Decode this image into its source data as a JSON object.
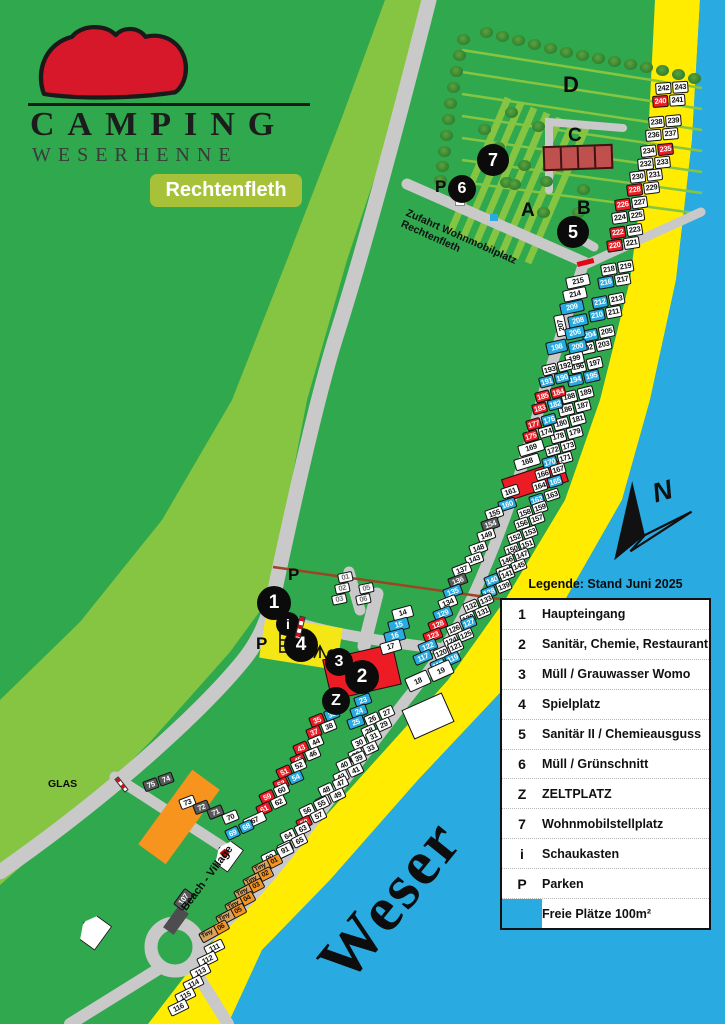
{
  "logo": {
    "line1": "CAMPING",
    "line2": "WESERHENNE",
    "badge": "Rechtenfleth"
  },
  "legend": {
    "title": "Legende: Stand Juni 2025",
    "rows": [
      {
        "sym": "1",
        "label": "Haupteingang",
        "swatch": false
      },
      {
        "sym": "2",
        "label": "Sanitär, Chemie, Restaurant",
        "swatch": false
      },
      {
        "sym": "3",
        "label": "Müll / Grauwasser Womo",
        "swatch": false
      },
      {
        "sym": "4",
        "label": "Spielplatz",
        "swatch": false
      },
      {
        "sym": "5",
        "label": "Sanitär II / Chemieausguss",
        "swatch": false
      },
      {
        "sym": "6",
        "label": "Müll / Grünschnitt",
        "swatch": false
      },
      {
        "sym": "Z",
        "label": "ZELTPLATZ",
        "swatch": false
      },
      {
        "sym": "7",
        "label": "Wohnmobilstellplatz",
        "swatch": false
      },
      {
        "sym": "i",
        "label": "Schaukasten",
        "swatch": false
      },
      {
        "sym": "P",
        "label": "Parken",
        "swatch": false
      },
      {
        "sym": "",
        "label": "Freie Plätze 100m²",
        "swatch": true
      }
    ]
  },
  "map_labels": {
    "weser": "Weser",
    "beach": "Beach - Village",
    "zufahrt": "Zufahrt Wohnmobilplatz Rechtenfleth",
    "glas": "GLAS",
    "north": "N",
    "sections": [
      {
        "t": "D",
        "x": 563,
        "y": 72,
        "s": 22
      },
      {
        "t": "C",
        "x": 568,
        "y": 125,
        "s": 19
      },
      {
        "t": "A",
        "x": 521,
        "y": 200,
        "s": 19
      },
      {
        "t": "B",
        "x": 577,
        "y": 198,
        "s": 19
      }
    ]
  },
  "markers": [
    {
      "t": "1",
      "x": 274,
      "y": 603,
      "r": 17
    },
    {
      "t": "i",
      "x": 288,
      "y": 624,
      "r": 12
    },
    {
      "t": "4",
      "x": 301,
      "y": 645,
      "r": 17
    },
    {
      "t": "3",
      "x": 339,
      "y": 662,
      "r": 14
    },
    {
      "t": "2",
      "x": 362,
      "y": 677,
      "r": 17
    },
    {
      "t": "Z",
      "x": 336,
      "y": 701,
      "r": 14
    },
    {
      "t": "5",
      "x": 573,
      "y": 232,
      "r": 16
    },
    {
      "t": "6",
      "x": 462,
      "y": 189,
      "r": 14
    },
    {
      "t": "7",
      "x": 493,
      "y": 160,
      "r": 16
    }
  ],
  "p_letters": [
    [
      288,
      565
    ],
    [
      256,
      634
    ],
    [
      435,
      177
    ]
  ],
  "colors": {
    "land": "#2fa84e",
    "dike": "#86c541",
    "beach": "#ffec00",
    "water": "#29abe2",
    "road": "#c9c9c9",
    "free_pitch": "#29abe2",
    "red_pitch": "#ed1c24",
    "gray_pitch": "#58595b",
    "building_c": "#c0504d",
    "orange": "#f7941d",
    "badge": "#a7c239",
    "hen_red": "#d7182a"
  },
  "pitch_rows": [
    [
      655,
      83,
      -4,
      "242:w,243:w",
      16,
      12
    ],
    [
      652,
      96,
      -4,
      "240:r,241:w",
      16,
      12
    ],
    [
      648,
      117,
      -5,
      "238:w,239:w",
      16,
      12
    ],
    [
      645,
      130,
      -5,
      "236:w,237:w",
      16,
      12
    ],
    [
      640,
      146,
      -6,
      "234:w,235:r",
      16,
      12
    ],
    [
      637,
      159,
      -6,
      "232:w,233:w",
      16,
      12
    ],
    [
      629,
      172,
      -7,
      "230:w,231:w",
      16,
      12
    ],
    [
      626,
      185,
      -7,
      "228:r,229:w",
      16,
      12
    ],
    [
      614,
      200,
      -8,
      "226:r,227:w",
      16,
      12
    ],
    [
      611,
      213,
      -8,
      "224:w,225:w",
      16,
      12
    ],
    [
      609,
      228,
      -9,
      "222:r,223:w",
      16,
      12
    ],
    [
      606,
      241,
      -9,
      "220:r,221:w",
      16,
      12
    ],
    [
      600,
      265,
      -10,
      "218:w,219:w",
      16,
      12
    ],
    [
      597,
      278,
      -10,
      "216:b,217:w",
      16,
      12
    ],
    [
      591,
      298,
      -11,
      "212:b,213:w",
      16,
      12
    ],
    [
      588,
      311,
      -11,
      "210:b,211:w",
      16,
      12
    ],
    [
      581,
      331,
      -12,
      "204:b,205:w",
      16,
      12
    ],
    [
      578,
      344,
      -12,
      "202:w,203:w",
      16,
      12
    ],
    [
      569,
      363,
      -13,
      "196:w,197:w",
      16,
      12
    ],
    [
      566,
      376,
      -13,
      "194:b,195:b",
      16,
      12
    ],
    [
      560,
      393,
      -14,
      "188:w,189:w",
      16,
      12
    ],
    [
      557,
      406,
      -14,
      "186:w,187:w",
      16,
      12
    ],
    [
      552,
      420,
      -15,
      "180:w,181:w",
      16,
      12
    ],
    [
      549,
      433,
      -15,
      "178:w,179:w",
      16,
      12
    ],
    [
      544,
      447,
      -16,
      "172:w,173:w",
      15,
      11
    ],
    [
      541,
      459,
      -16,
      "170:b,171:w",
      15,
      11
    ],
    [
      534,
      471,
      -17,
      "166:w,167:w",
      15,
      11
    ],
    [
      531,
      483,
      -17,
      "164:w,165:b",
      15,
      11
    ],
    [
      528,
      497,
      -18,
      "162:b,163:w",
      15,
      11
    ],
    [
      516,
      510,
      -19,
      "158:w,159:w",
      15,
      11
    ],
    [
      513,
      521,
      -19,
      "156:w,157:w",
      15,
      11
    ],
    [
      506,
      535,
      -20,
      "152:w,153:w",
      15,
      11
    ],
    [
      503,
      547,
      -20,
      "150:w,151:w",
      15,
      11
    ],
    [
      498,
      558,
      -21,
      "146:w,147:w",
      15,
      11
    ],
    [
      495,
      569,
      -21,
      "144:w,145:w",
      15,
      11
    ],
    [
      483,
      578,
      -22,
      "140:b,141:w",
      15,
      11
    ],
    [
      480,
      590,
      -22,
      "138:b,139:w",
      15,
      11
    ],
    [
      462,
      604,
      -23,
      "132:w,133:w",
      15,
      11
    ],
    [
      459,
      616,
      -23,
      "130:w,131:w",
      15,
      11
    ],
    [
      445,
      627,
      -23,
      "126:w,127:b",
      15,
      11
    ],
    [
      442,
      639,
      -23,
      "124:w,125:w",
      15,
      11
    ],
    [
      432,
      651,
      -24,
      "120:w,121:w",
      15,
      11
    ],
    [
      429,
      663,
      -24,
      "118:b,119:b",
      15,
      11
    ],
    [
      404,
      679,
      -24,
      "18:w,19:w",
      24,
      15
    ],
    [
      363,
      717,
      -24,
      "26:w,27:w",
      15,
      11
    ],
    [
      360,
      729,
      -24,
      "28:w,29:w",
      15,
      11
    ],
    [
      350,
      741,
      -25,
      "30:w,31:w",
      15,
      11
    ],
    [
      347,
      753,
      -25,
      "32:w,33:w",
      15,
      11
    ],
    [
      335,
      763,
      -25,
      "40:w,39:w",
      15,
      11
    ],
    [
      332,
      775,
      -25,
      "42:w,41:w",
      15,
      11
    ],
    [
      317,
      788,
      -25,
      "48:w,47:w",
      15,
      11
    ],
    [
      314,
      800,
      -25,
      "50:w,49:w",
      15,
      11
    ],
    [
      298,
      809,
      -26,
      "56:w,55:w",
      15,
      11
    ],
    [
      295,
      821,
      -26,
      "58:r,57:w",
      15,
      11
    ],
    [
      279,
      834,
      -26,
      "64:w,63:w",
      15,
      11
    ],
    [
      276,
      846,
      -26,
      "66:w,65:w",
      15,
      11
    ],
    [
      260,
      856,
      -26,
      "90:w,91:w",
      16,
      12
    ],
    [
      251,
      867,
      -27,
      "Tiny 01:t",
      31,
      11
    ],
    [
      242,
      880,
      -27,
      "Tiny 02:t",
      31,
      11
    ],
    [
      233,
      892,
      -28,
      "Tiny 03:t",
      31,
      11
    ],
    [
      224,
      905,
      -28,
      "Tiny 04:t",
      31,
      11
    ],
    [
      215,
      917,
      -28,
      "Tiny 05:t",
      31,
      11
    ],
    [
      198,
      934,
      -29,
      "Tiny 06:t",
      31,
      11
    ],
    [
      203,
      947,
      -26,
      "111:w",
      20,
      11
    ],
    [
      196,
      959,
      -26,
      "112:w",
      20,
      11
    ],
    [
      189,
      971,
      -26,
      "113:w",
      20,
      11
    ],
    [
      182,
      983,
      -26,
      "114:w",
      20,
      11
    ],
    [
      174,
      995,
      -26,
      "115:w",
      20,
      11
    ],
    [
      167,
      1007,
      -26,
      "116:w",
      20,
      11
    ],
    [
      565,
      278,
      -12,
      "215:w",
      24,
      12
    ],
    [
      562,
      291,
      -12,
      "214:w",
      24,
      12
    ],
    [
      559,
      304,
      -12,
      "209:b",
      24,
      12
    ],
    [
      553,
      316,
      -12,
      "207:wv",
      11,
      22
    ],
    [
      567,
      317,
      -12,
      "208:b",
      20,
      12
    ],
    [
      564,
      329,
      -12,
      "206:b",
      20,
      12
    ],
    [
      545,
      343,
      -13,
      "198:b",
      21,
      13
    ],
    [
      567,
      343,
      -13,
      "200:b",
      19,
      12
    ],
    [
      564,
      355,
      -13,
      "199:w",
      19,
      12
    ],
    [
      541,
      366,
      -14,
      "193:w,192:w",
      15,
      11
    ],
    [
      538,
      378,
      -14,
      "191:b,190:b",
      15,
      11
    ],
    [
      534,
      393,
      -15,
      "185:r,184:r",
      15,
      11
    ],
    [
      531,
      405,
      -15,
      "183:r,182:b",
      15,
      11
    ],
    [
      525,
      421,
      -16,
      "177:r,176:b",
      15,
      11
    ],
    [
      522,
      433,
      -16,
      "175:r,174:w",
      15,
      11
    ],
    [
      517,
      446,
      -17,
      "169:w",
      26,
      12
    ],
    [
      513,
      460,
      -17,
      "168:w",
      26,
      12
    ],
    [
      500,
      489,
      -18,
      "161:w",
      18,
      11
    ],
    [
      497,
      502,
      -18,
      "160:b",
      18,
      11
    ],
    [
      484,
      511,
      -19,
      "155:w",
      18,
      11
    ],
    [
      480,
      522,
      -19,
      "154:g",
      18,
      11
    ],
    [
      476,
      533,
      -19,
      "149:w",
      18,
      11
    ],
    [
      468,
      546,
      -20,
      "148:w",
      18,
      11
    ],
    [
      464,
      557,
      -20,
      "143:w",
      18,
      11
    ],
    [
      451,
      568,
      -21,
      "137:w",
      19,
      11
    ],
    [
      447,
      579,
      -21,
      "136:g",
      19,
      11
    ],
    [
      442,
      590,
      -21,
      "135:b",
      19,
      11
    ],
    [
      437,
      601,
      -22,
      "134:w",
      19,
      11
    ],
    [
      432,
      612,
      -22,
      "129:b",
      19,
      11
    ],
    [
      427,
      623,
      -22,
      "128:r",
      19,
      11
    ],
    [
      422,
      634,
      -22,
      "123:r",
      19,
      11
    ],
    [
      417,
      645,
      -23,
      "122:b",
      19,
      11
    ],
    [
      412,
      656,
      -23,
      "117:b",
      19,
      11
    ],
    [
      391,
      610,
      -15,
      "14:w",
      21,
      12
    ],
    [
      387,
      622,
      -15,
      "15:b",
      21,
      12
    ],
    [
      383,
      633,
      -15,
      "16:b",
      21,
      12
    ],
    [
      379,
      644,
      -16,
      "17:w",
      21,
      12
    ],
    [
      337,
      574,
      -12,
      "01:y",
      15,
      10
    ],
    [
      334,
      585,
      -12,
      "02:y",
      15,
      10
    ],
    [
      331,
      596,
      -12,
      "03:y",
      15,
      10
    ],
    [
      358,
      585,
      -12,
      "05:y",
      15,
      10
    ],
    [
      355,
      596,
      -12,
      "06:y",
      15,
      10
    ],
    [
      353,
      698,
      -20,
      "23:b",
      17,
      11
    ],
    [
      349,
      709,
      -20,
      "24:b",
      17,
      11
    ],
    [
      346,
      720,
      -20,
      "25:b",
      17,
      11
    ],
    [
      308,
      718,
      -22,
      "35:r,36:b",
      15,
      11
    ],
    [
      305,
      730,
      -22,
      "37:r,38:w",
      15,
      11
    ],
    [
      292,
      746,
      -23,
      "43:r,44:w",
      15,
      11
    ],
    [
      289,
      758,
      -23,
      "45:r,46:w",
      15,
      11
    ],
    [
      275,
      770,
      -24,
      "51:r,52:w",
      15,
      11
    ],
    [
      272,
      782,
      -24,
      "53:r,54:b",
      15,
      11
    ],
    [
      258,
      795,
      -25,
      "59:r,60:w",
      15,
      11
    ],
    [
      255,
      807,
      -25,
      "61:r,62:w",
      15,
      11
    ],
    [
      242,
      820,
      -25,
      "67:w",
      23,
      11
    ],
    [
      224,
      831,
      -25,
      "69:b,68:b",
      14,
      11
    ],
    [
      142,
      782,
      -20,
      "75:g,74:g",
      15,
      11
    ],
    [
      178,
      800,
      -21,
      "73:w",
      16,
      11
    ],
    [
      192,
      805,
      -21,
      "72:g",
      16,
      11
    ],
    [
      206,
      810,
      -22,
      "71:g",
      16,
      11
    ],
    [
      221,
      815,
      -22,
      "70:w",
      16,
      11
    ],
    [
      173,
      904,
      -54,
      "107:g",
      20,
      12
    ]
  ],
  "trees": [
    [
      480,
      27
    ],
    [
      496,
      31
    ],
    [
      512,
      35
    ],
    [
      528,
      39
    ],
    [
      544,
      43
    ],
    [
      560,
      47
    ],
    [
      576,
      50
    ],
    [
      592,
      53
    ],
    [
      608,
      56
    ],
    [
      624,
      59
    ],
    [
      640,
      62
    ],
    [
      656,
      65
    ],
    [
      672,
      69
    ],
    [
      688,
      73
    ],
    [
      457,
      34
    ],
    [
      453,
      50
    ],
    [
      450,
      66
    ],
    [
      447,
      82
    ],
    [
      444,
      98
    ],
    [
      442,
      114
    ],
    [
      440,
      130
    ],
    [
      438,
      146
    ],
    [
      436,
      161
    ],
    [
      434,
      175
    ],
    [
      505,
      107
    ],
    [
      532,
      121
    ],
    [
      492,
      142
    ],
    [
      518,
      160
    ],
    [
      500,
      177
    ],
    [
      478,
      124
    ],
    [
      540,
      176
    ],
    [
      577,
      184
    ],
    [
      572,
      207
    ],
    [
      537,
      207
    ],
    [
      508,
      179
    ]
  ]
}
